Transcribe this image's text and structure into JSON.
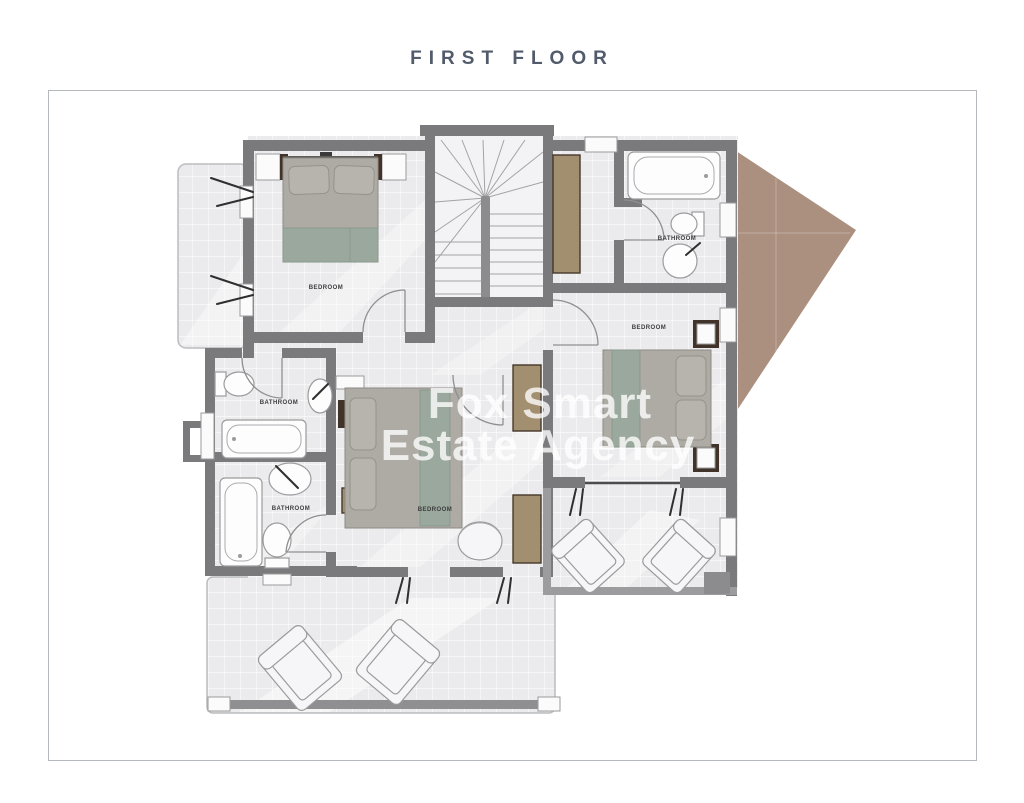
{
  "title": "FIRST FLOOR",
  "watermark": {
    "line1": "Fox Smart",
    "line2": "Estate Agency"
  },
  "rooms": {
    "bedroom_top_left": "BEDROOM",
    "bathroom_top_right": "BATHROOM",
    "bedroom_right": "BEDROOM",
    "bathroom_middle": "BATHROOM",
    "bathroom_lower": "BATHROOM",
    "bedroom_middle": "BEDROOM"
  },
  "colors": {
    "roof": "#ab9080",
    "wall": "#7a7a7c",
    "wood": "#a28f6f",
    "bed_accent": "#9aa89d",
    "title_color": "#515b6b"
  }
}
